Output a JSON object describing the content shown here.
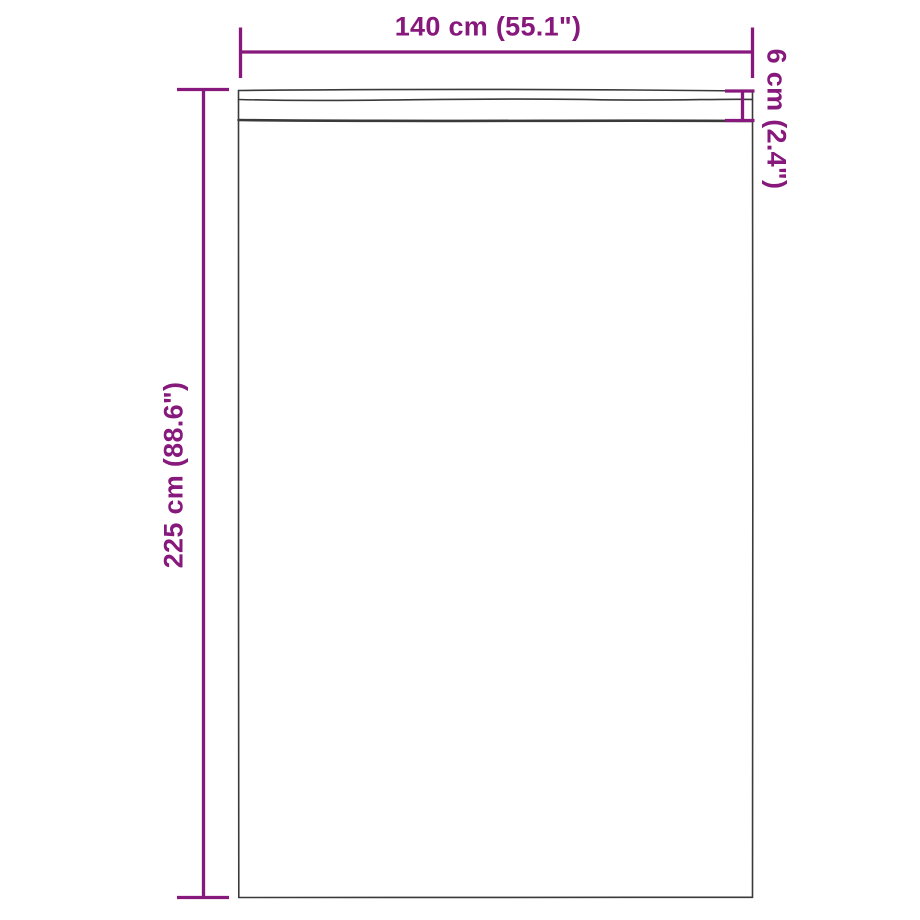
{
  "colors": {
    "accent": "#87187c",
    "outline": "#3a3a3a",
    "background": "#ffffff"
  },
  "dimensions": {
    "width": {
      "label": "140 cm (55.1\")",
      "orientation": "horizontal"
    },
    "height": {
      "label": "225 cm (88.6\")",
      "orientation": "vertical"
    },
    "header": {
      "label": "6 cm (2.4\")",
      "orientation": "vertical"
    }
  }
}
